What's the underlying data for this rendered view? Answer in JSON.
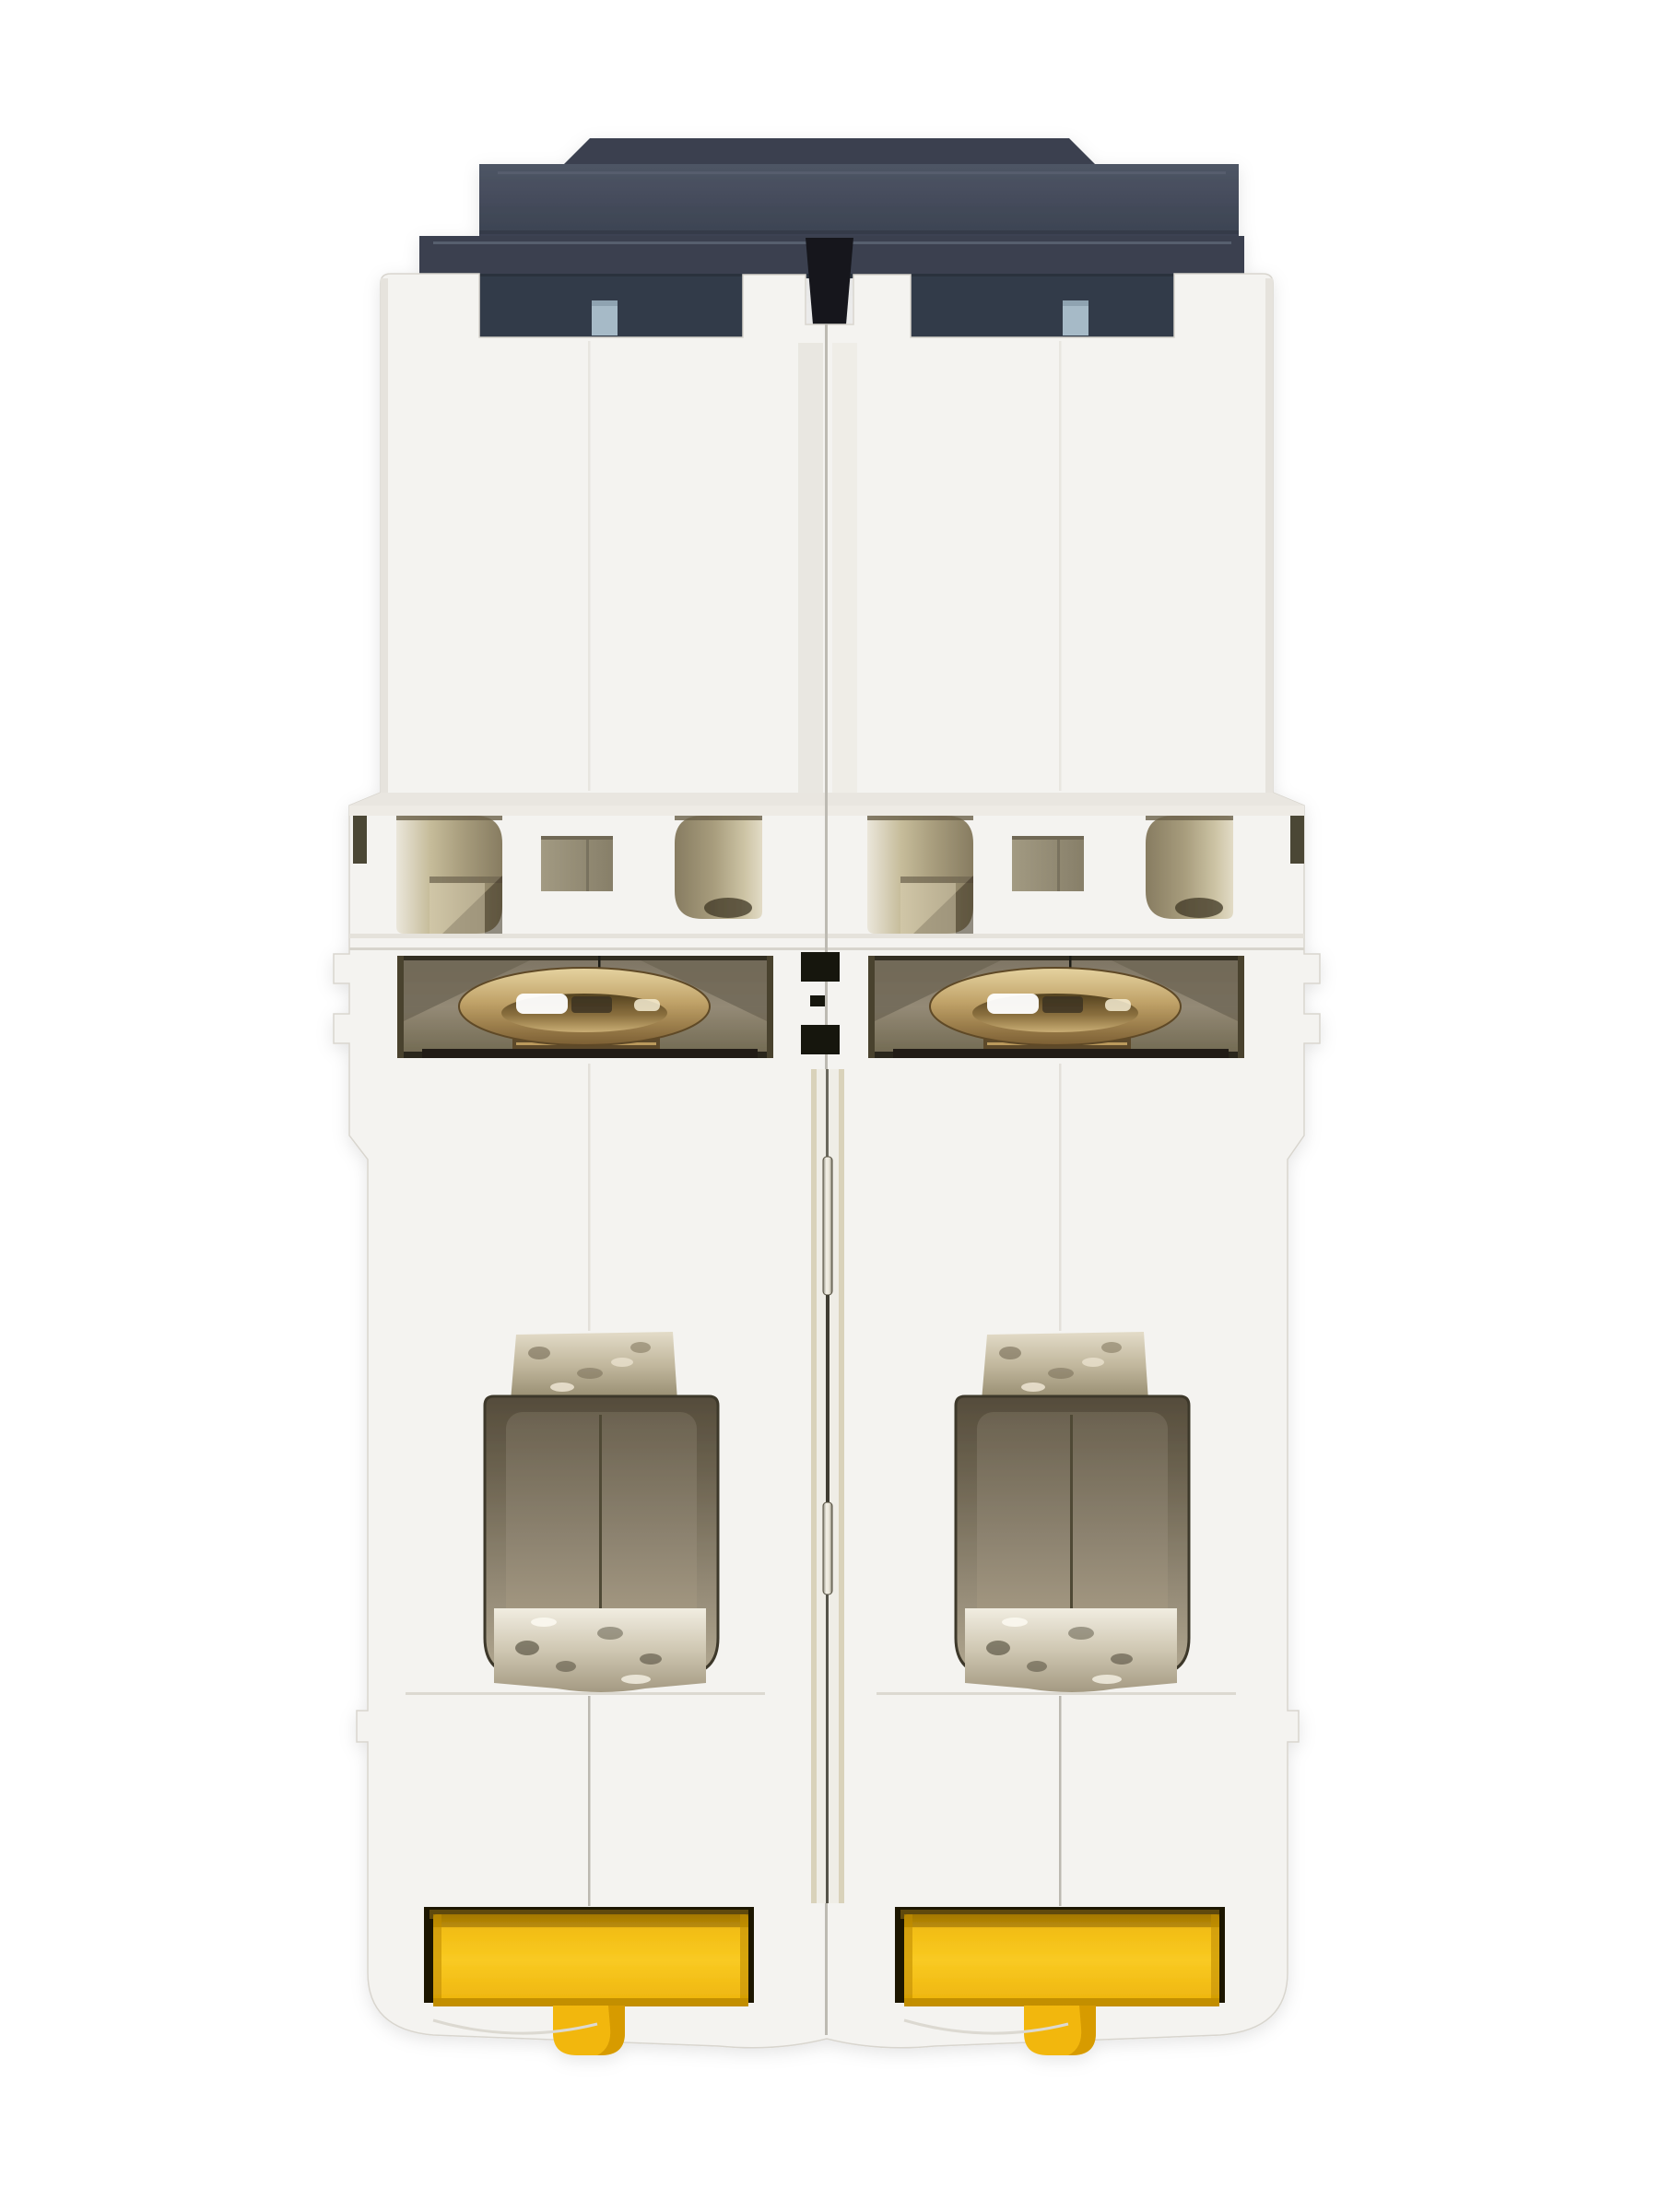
{
  "scene": {
    "type": "product-photo",
    "subject": "2-pole DIN-rail miniature circuit breaker photographed end-on (bottom/terminal face)",
    "background": "plain white studio background",
    "visible_text": "none",
    "pole_count": 2
  },
  "colors": {
    "background": "#ffffff",
    "body_white": "#f4f3f0",
    "body_edge": "#d8d5ce",
    "body_shade": "#e9e6e0",
    "seam": "#bdbab2",
    "slate_bump": "#3a4150",
    "slate": "#3a414f",
    "slate_light": "#4e5565",
    "slate_dark": "#333a48",
    "slate_deep": "#17191f",
    "blue_tab": "#a6bac7",
    "vent_beige": "#a89d7d",
    "vent_dark": "#3f3724",
    "square_metal": "#a29a82",
    "recess_bg": "#8a8170",
    "recess_dark": "#2c261a",
    "brass_light": "#e6d3a0",
    "brass_mid": "#c0a268",
    "brass_dark": "#7c5f33",
    "thread_dark": "#5d4a2c",
    "cavity_dark": "#554c3b",
    "cavity_light": "#ab9f87",
    "chrome_light": "#f1ede1",
    "tab_metal": "#c0b69c",
    "rod_light": "#f4f1e8",
    "channel_beige": "#d9d2ba",
    "yellow": "#f9ca22",
    "yellow_deep": "#edb30c",
    "yellow_shadow": "#8a6400",
    "clip_slot": "#1e1703"
  },
  "parts": {
    "cap": "dark slate plastic cap with raised toggle ridge",
    "blue_tab": "light blue-gray indicator tab",
    "vents": "arc-vent openings with beige interior",
    "screw_ring": "brass terminal screw ring over threads",
    "terminal_cavity": "wire terminal cavity with chrome clamp",
    "crimp_tab": "crimped metal terminal tab",
    "center_rod": "metal linkage pin in center seam channel",
    "din_clip": "yellow DIN-rail release clip with stem"
  }
}
